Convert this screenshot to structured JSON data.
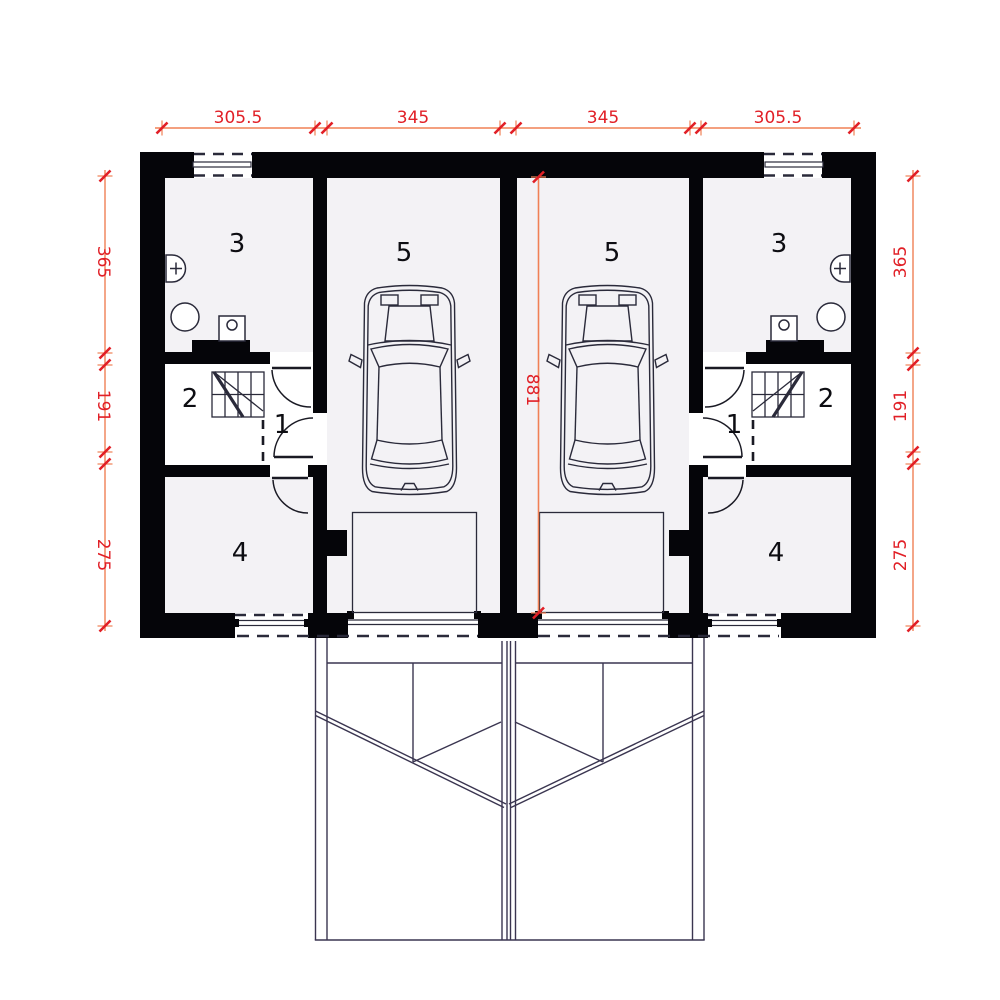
{
  "plan_type": "duplex-ground-floor-plan",
  "dimensions": {
    "top": [
      "305.5",
      "345",
      "345",
      "305.5"
    ],
    "left": [
      "365",
      "191",
      "275"
    ],
    "right": [
      "365",
      "191",
      "275"
    ],
    "center": "881"
  },
  "rooms": {
    "left_unit": {
      "hall": "1",
      "stairs_room": "2",
      "bathroom": "3",
      "utility": "4",
      "garage": "5"
    },
    "right_unit": {
      "hall": "1",
      "stairs_room": "2",
      "bathroom": "3",
      "utility": "4",
      "garage": "5"
    }
  },
  "colors": {
    "wall": "#050509",
    "floor": "#f3f2f5",
    "thin_line": "#3a3550",
    "dimension_line": "#f08055",
    "dimension_mark": "#e11f26",
    "dimension_text": "#e11f26",
    "background": "#ffffff"
  }
}
